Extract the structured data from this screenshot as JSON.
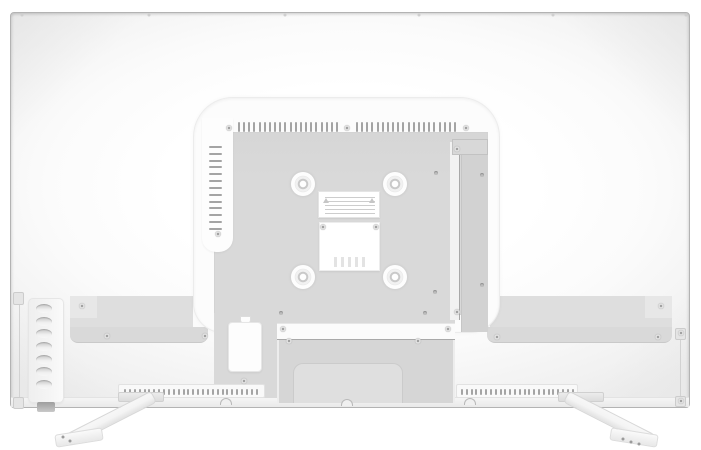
{
  "subject": "television-rear-panel",
  "colors": {
    "background": "#ffffff",
    "body": "#fbfbfb",
    "frame_line": "#b3b3b3",
    "recess": "#fcfcfc",
    "plate": "#d9d9d9",
    "plate_dark": "#d2d2d2",
    "housing": "#d6d6d6",
    "housing_inner": "#dfdfdf",
    "shoulder": "#dedede",
    "ledge": "#d9d9d9",
    "slot": "#a4a4a4",
    "seam": "#a8a8a8",
    "sticker": "#ffffff",
    "port_strip": "#f4f4f4",
    "plug": "#aeaeae",
    "stand": "#f4f4f4",
    "stand_edge": "#d7d7d7"
  },
  "features": {
    "top_edge_screws": {
      "points": [
        [
          22,
          15
        ],
        [
          149,
          15
        ],
        [
          285,
          15
        ],
        [
          419,
          15
        ],
        [
          553,
          15
        ],
        [
          686,
          15
        ]
      ]
    },
    "top_vents": {
      "slots_per_group": 20
    },
    "side_vents": {
      "slots": 13
    },
    "bottom_vents": {
      "left_slots": 28,
      "right_slots": 24
    },
    "av_ports": {
      "count": 7
    },
    "vesa_mounts": {
      "points": [
        [
          303,
          184
        ],
        [
          395,
          184
        ],
        [
          303,
          277
        ],
        [
          395,
          277
        ]
      ]
    },
    "screws": {
      "points": [
        [
          229,
          128
        ],
        [
          347,
          128
        ],
        [
          466,
          128
        ],
        [
          218,
          234
        ],
        [
          457,
          149
        ],
        [
          457,
          312
        ],
        [
          323,
          227
        ],
        [
          376,
          227
        ],
        [
          283,
          329
        ],
        [
          448,
          329
        ],
        [
          289,
          341
        ],
        [
          418,
          341
        ],
        [
          82,
          306
        ],
        [
          107,
          336
        ],
        [
          205,
          336
        ],
        [
          497,
          337
        ],
        [
          658,
          337
        ],
        [
          661,
          306
        ],
        [
          244,
          381
        ],
        [
          681,
          333
        ],
        [
          681,
          401
        ]
      ]
    },
    "pin_holes": {
      "points": [
        [
          436,
          173
        ],
        [
          435,
          292
        ],
        [
          482,
          175
        ],
        [
          482,
          285
        ],
        [
          281,
          313
        ],
        [
          425,
          313
        ]
      ]
    },
    "lock_tabs": {
      "points": [
        [
          226,
          398
        ],
        [
          347,
          399
        ],
        [
          470,
          398
        ]
      ]
    },
    "grip_dots": {
      "points": [
        [
          63,
          437
        ],
        [
          70,
          441
        ],
        [
          623,
          439
        ],
        [
          631,
          442
        ],
        [
          639,
          444
        ]
      ]
    }
  }
}
